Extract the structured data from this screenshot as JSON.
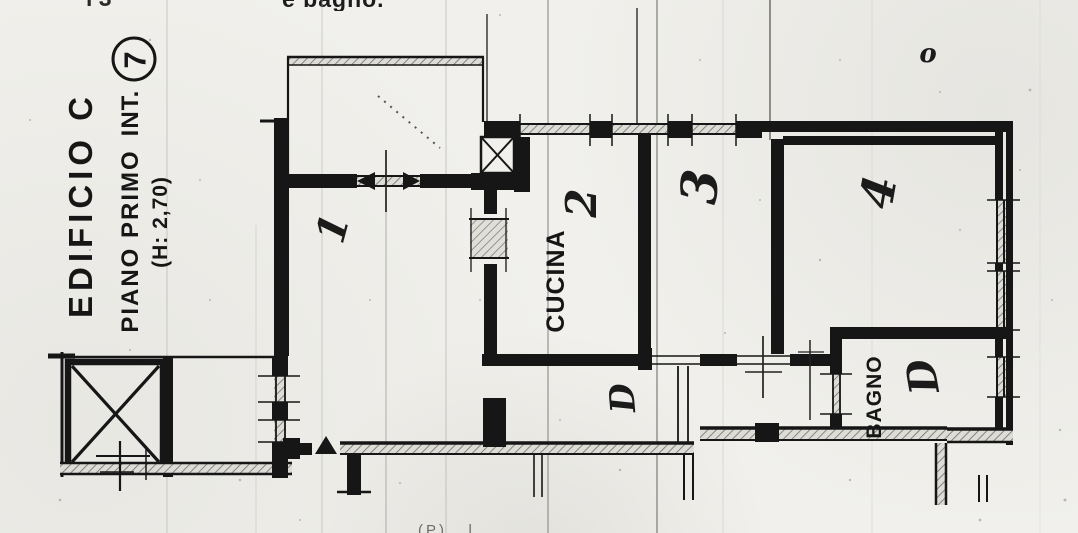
{
  "fragments": {
    "top": "e bagno.",
    "top_left": "l  3",
    "bottom": "(P) . l ."
  },
  "title_block": {
    "building": "EDIFICIO  C",
    "floor": "PIANO PRIMO",
    "int_label": "INT.",
    "int_number": "7",
    "height_note": "(H: 2,70)"
  },
  "room_labels": {
    "room1": "1",
    "room2": "2",
    "room3": "3",
    "room4": "4",
    "kitchen": "CUCINA",
    "bathroom": "BAGNO",
    "hallway": "D",
    "bath_door": "D",
    "mark_o": "o"
  },
  "colors": {
    "paper": "#f1f0ec",
    "ink": "#161616",
    "scanline_light": "#b5b4ae",
    "scanline_dark": "#8a8a85"
  }
}
